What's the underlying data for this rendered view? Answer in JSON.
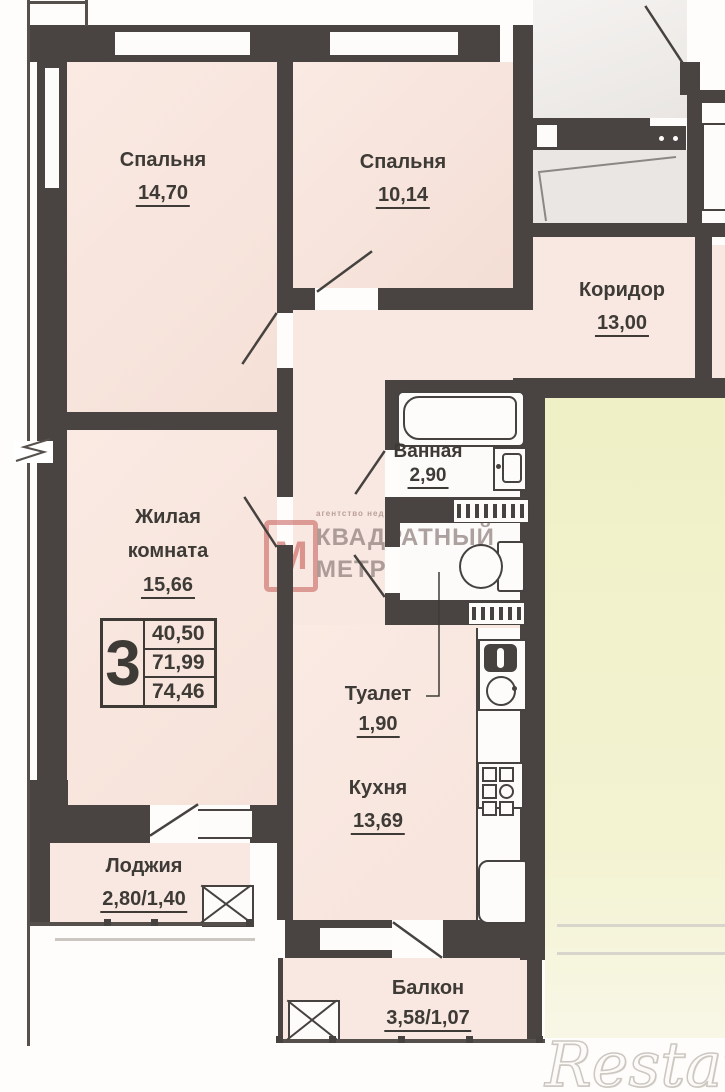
{
  "plan": {
    "rooms": [
      {
        "key": "bedroom-1",
        "name": "Спальня",
        "area": "14,70"
      },
      {
        "key": "bedroom-2",
        "name": "Спальня",
        "area": "10,14"
      },
      {
        "key": "corridor",
        "name": "Коридор",
        "area": "13,00"
      },
      {
        "key": "bathroom",
        "name": "Ванная",
        "area": "2,90"
      },
      {
        "key": "living-room",
        "name": "Жилая комната",
        "area": "15,66"
      },
      {
        "key": "toilet",
        "name": "Туалет",
        "area": "1,90"
      },
      {
        "key": "kitchen",
        "name": "Кухня",
        "area": "13,69"
      },
      {
        "key": "loggia",
        "name": "Лоджия",
        "area": "2,80/1,40"
      },
      {
        "key": "balcony",
        "name": "Балкон",
        "area": "3,58/1,07"
      }
    ],
    "summary": {
      "rooms_count": "3",
      "living_area": "40,50",
      "area_without_balcony": "71,99",
      "total_area": "74,46"
    },
    "watermarks": {
      "agency": {
        "logo_letter": "М",
        "small_text": "агентство недвижимости",
        "line1": "КВАДРАТНЫЙ",
        "line2": "МЕТР"
      },
      "portal": "Restate"
    },
    "colors": {
      "wall": "#494441",
      "room_fill": "#f9e8e1",
      "wet_room_fill": "#fcfbfa",
      "common_area_fill": "#edeae7",
      "adjacent_room_fill": "#f1f1cb",
      "agency_red": "#c4605c",
      "portal_watermark": "#ffffff"
    }
  }
}
